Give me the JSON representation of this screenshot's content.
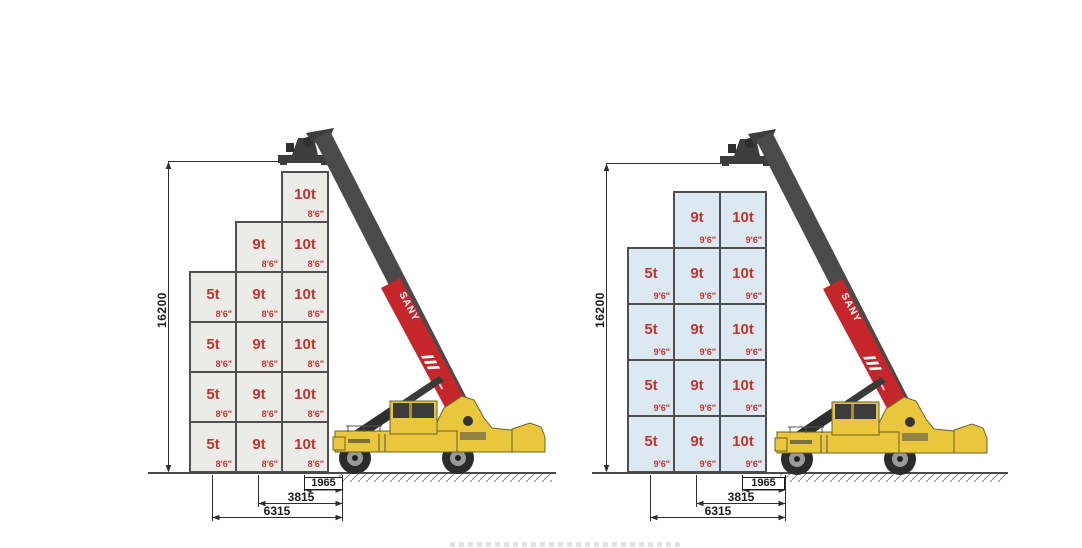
{
  "machine": {
    "brand": "SANY",
    "body_color": "#e9c63b",
    "boom_color": "#4a4a4a",
    "boom_accent_color": "#c4262b"
  },
  "colors": {
    "label_red": "#c1332f",
    "container_border": "#4f4f4f",
    "dimension_line": "#2e2e2e",
    "left_container_fill": "#ebece8",
    "right_container_fill": "#dce9f2"
  },
  "diagrams": [
    {
      "name": "stacking-capacity-8ft6-containers",
      "container_height_label": "8'6\"",
      "container_fill": "#ebece8",
      "height_dimension": "16200",
      "outreach_dimensions": [
        "1965",
        "3815",
        "6315"
      ],
      "columns": [
        {
          "weight": "5t",
          "tiers": 4
        },
        {
          "weight": "9t",
          "tiers": 5
        },
        {
          "weight": "10t",
          "tiers": 6
        }
      ]
    },
    {
      "name": "stacking-capacity-9ft6-containers",
      "container_height_label": "9'6\"",
      "container_fill": "#dce9f2",
      "height_dimension": "16200",
      "outreach_dimensions": [
        "1965",
        "3815",
        "6315"
      ],
      "columns": [
        {
          "weight": "5t",
          "tiers": 4
        },
        {
          "weight": "9t",
          "tiers": 5
        },
        {
          "weight": "10t",
          "tiers": 5
        }
      ]
    }
  ]
}
